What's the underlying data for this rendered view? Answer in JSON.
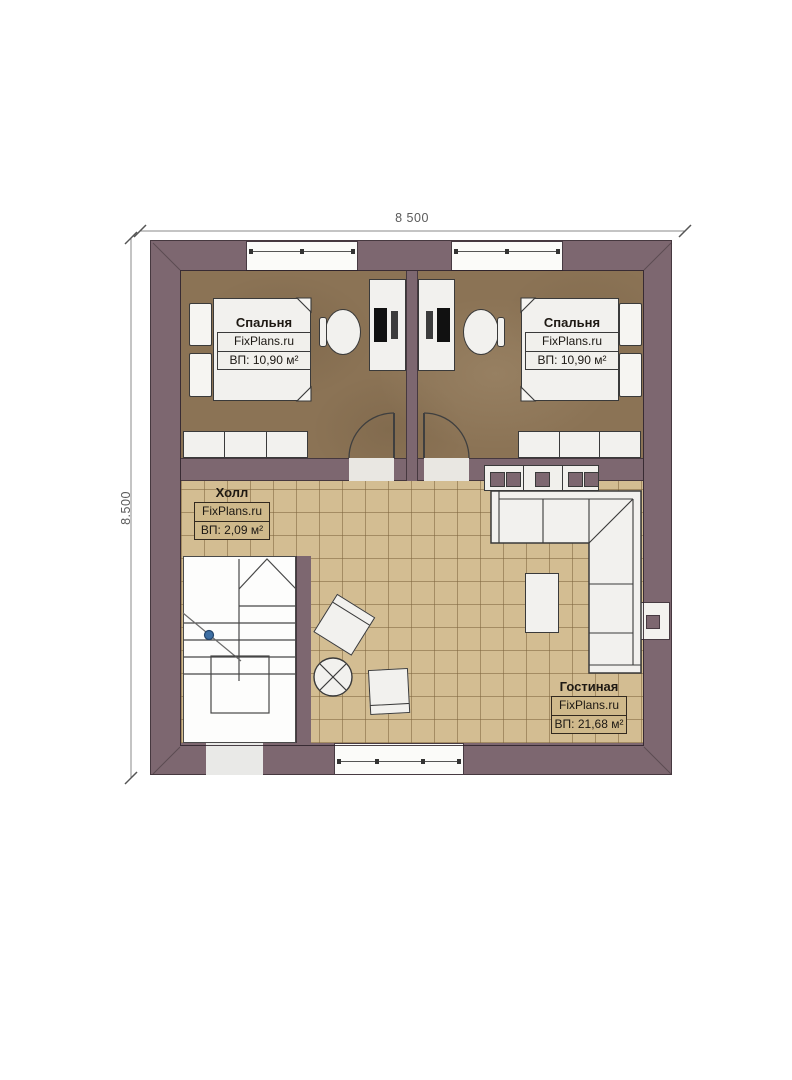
{
  "dimensions": {
    "top": "8 500",
    "left": "8.500"
  },
  "rooms": {
    "bedroom_left": {
      "name": "Спальня",
      "brand": "FixPlans.ru",
      "area": "ВП: 10,90 м²"
    },
    "bedroom_right": {
      "name": "Спальня",
      "brand": "FixPlans.ru",
      "area": "ВП: 10,90 м²"
    },
    "hall": {
      "name": "Холл",
      "brand": "FixPlans.ru",
      "area": "ВП: 2,09 м²"
    },
    "living": {
      "name": "Гостиная",
      "brand": "FixPlans.ru",
      "area": "ВП: 21,68 м²"
    }
  },
  "colors": {
    "wall": "#7d6770",
    "wall_line": "#46383f",
    "bed_floor": "#8b7355",
    "tile": "#d3bd92",
    "white": "#f2f1ee",
    "line": "#3a3a3a",
    "dim": "#8a8a8a",
    "marker_blue": "#3e6fa3"
  }
}
